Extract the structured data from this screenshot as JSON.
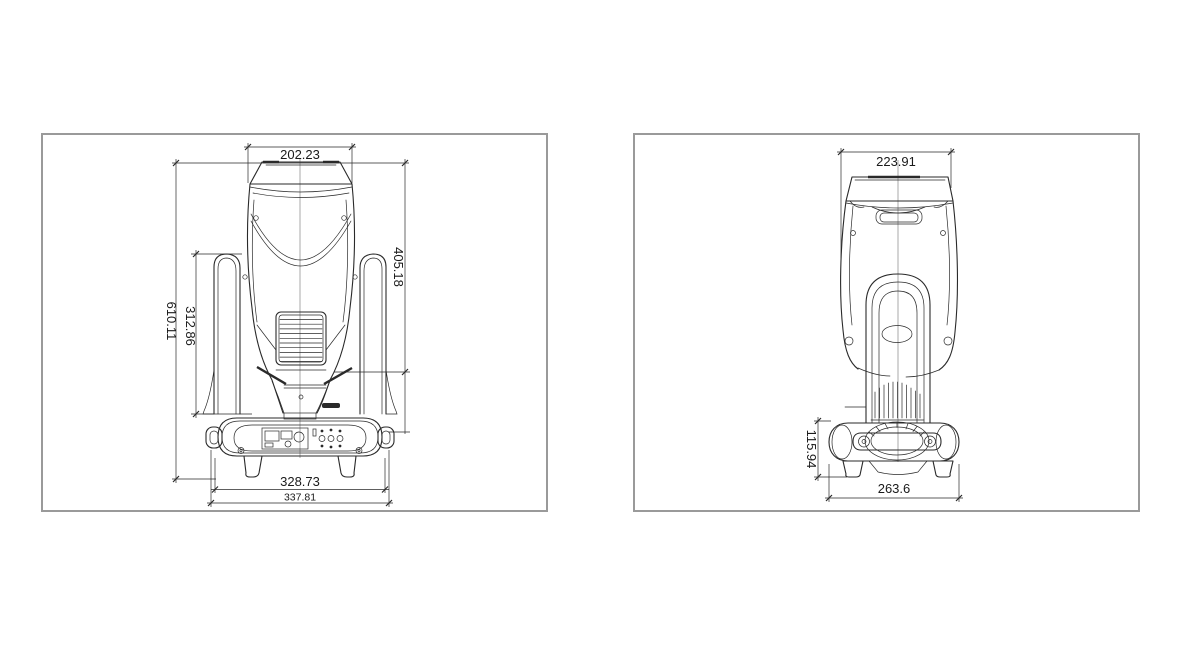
{
  "colors": {
    "line": "#2a2a2a",
    "panel_border": "#9a9a9a",
    "background": "#ffffff"
  },
  "front_view": {
    "dim_top_width": "202.23",
    "dim_head_height": "405.18",
    "dim_yoke_height": "312.86",
    "dim_total_height": "610.11",
    "dim_base_width": "328.73",
    "dim_overall_width": "337.81"
  },
  "side_view": {
    "dim_top_width": "223.91",
    "dim_base_height": "115.94",
    "dim_base_depth": "263.6"
  }
}
